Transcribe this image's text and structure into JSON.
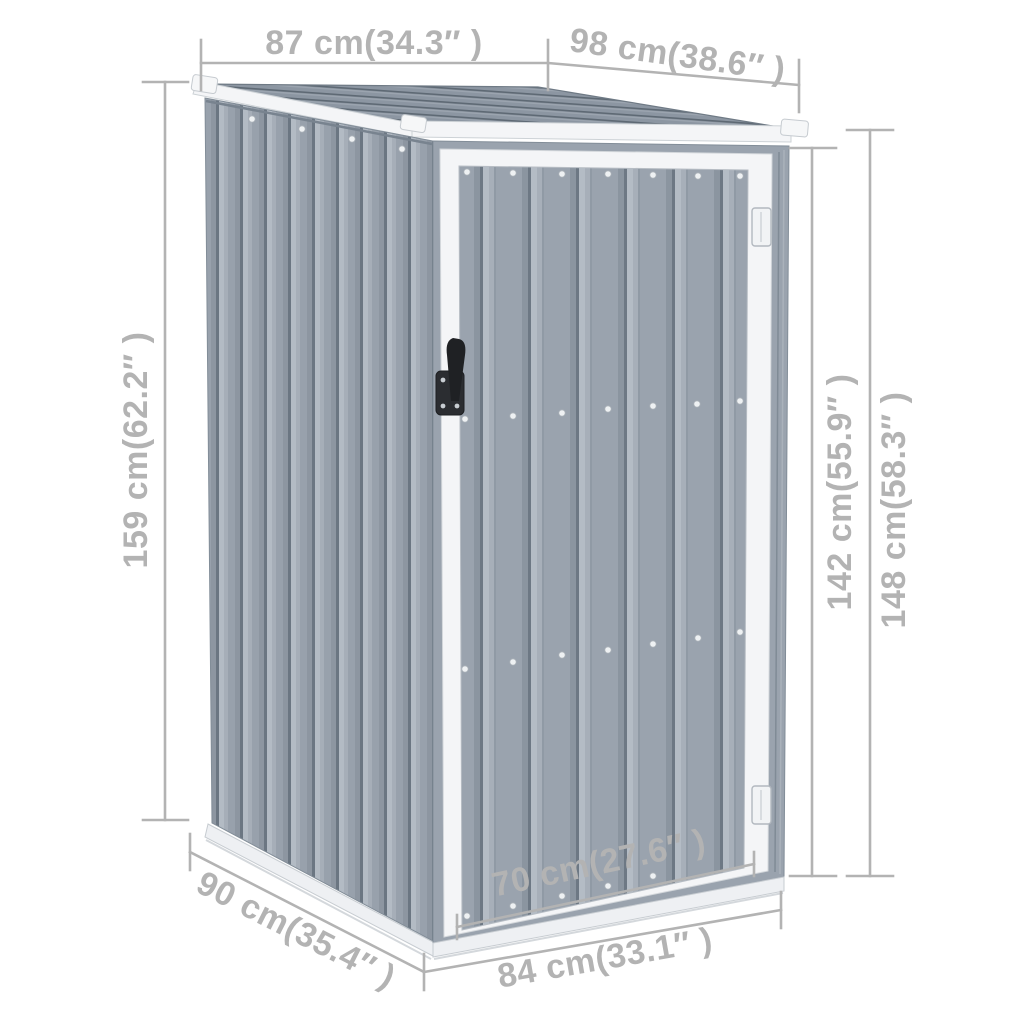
{
  "figure": {
    "description": "Garden metal tool shed with pent roof and single hinged door, shown as a product dimension diagram",
    "background_color": "#ffffff"
  },
  "colors": {
    "panel_gray": "#98a1ac",
    "panel_highlight": "#b3bbc4",
    "panel_groove": "#6b7682",
    "roof_gray": "#8c96a2",
    "roof_groove": "#5e6974",
    "trim_white": "#f4f5f7",
    "rail_white": "#eef0f3",
    "gap_shadow": "#43494f",
    "dimension_gray": "#b3b3b3",
    "handle_black": "#25272b",
    "rivet_white": "#eef1f3"
  },
  "dimensions": [
    {
      "id": "roof-left-width",
      "label": "87 cm(34.3″ )"
    },
    {
      "id": "roof-right-width",
      "label": "98 cm(38.6″ )"
    },
    {
      "id": "left-height",
      "label": "159 cm(62.2″ )"
    },
    {
      "id": "door-height",
      "label": "142 cm(55.9″ )"
    },
    {
      "id": "right-height",
      "label": "148 cm(58.3″ )"
    },
    {
      "id": "side-depth",
      "label": "90 cm(35.4″ )"
    },
    {
      "id": "door-width",
      "label": "70 cm(27.6″ )"
    },
    {
      "id": "front-width",
      "label": "84 cm(33.1″ )"
    }
  ]
}
